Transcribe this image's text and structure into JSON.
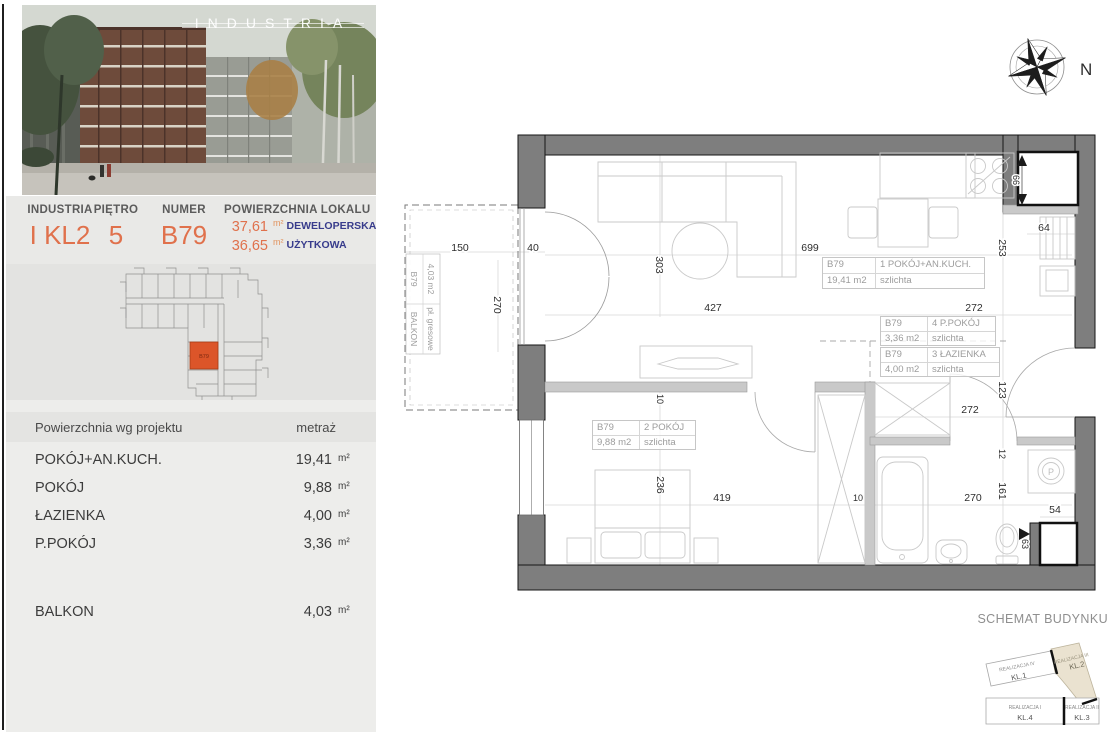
{
  "hero": {
    "overlay_title": "INDUSTRIA"
  },
  "summary": {
    "columns": [
      {
        "label": "INDUSTRIA",
        "value": "I KL2"
      },
      {
        "label": "PIĘTRO",
        "value": "5"
      },
      {
        "label": "NUMER",
        "value": "B79"
      }
    ],
    "area_label": "POWIERZCHNIA LOKALU",
    "areas": [
      {
        "value": "37,61",
        "unit": "m²",
        "kind": "DEWELOPERSKA"
      },
      {
        "value": "36,65",
        "unit": "m²",
        "kind": "UŻYTKOWA"
      }
    ]
  },
  "site_plan": {
    "highlight_unit": "B79"
  },
  "area_table": {
    "header_left": "Powierzchnia wg projektu",
    "header_right": "metraż",
    "rows": [
      {
        "name": "POKÓJ+AN.KUCH.",
        "value": "19,41",
        "unit": "m²"
      },
      {
        "name": "POKÓJ",
        "value": "9,88",
        "unit": "m²"
      },
      {
        "name": "ŁAZIENKA",
        "value": "4,00",
        "unit": "m²"
      },
      {
        "name": "P.POKÓJ",
        "value": "3,36",
        "unit": "m²"
      },
      {
        "name": "BALKON",
        "value": "4,03",
        "unit": "m²"
      }
    ]
  },
  "floor_plan": {
    "compass_label": "N",
    "washer_symbol": "P",
    "rooms": [
      {
        "unit": "B79",
        "name": "1 POKÓJ+AN.KUCH.",
        "area": "19,41 m2",
        "floor": "szlichta"
      },
      {
        "unit": "B79",
        "name": "2 POKÓJ",
        "area": "9,88 m2",
        "floor": "szlichta"
      },
      {
        "unit": "B79",
        "name": "3 ŁAZIENKA",
        "area": "4,00 m2",
        "floor": "szlichta"
      },
      {
        "unit": "B79",
        "name": "4 P.POKÓJ",
        "area": "3,36 m2",
        "floor": "szlichta"
      },
      {
        "unit": "B79",
        "name": "BALKON",
        "area": "4,03 m2",
        "floor": "pł. gresowe"
      }
    ],
    "dims": {
      "balcony_width": "150",
      "balcony_door": "40",
      "balcony_depth": "270",
      "kitchen_width": "699",
      "living_width": "427",
      "living_height": "303",
      "kitchen_depth": "253",
      "shaft_top_h": "66",
      "shaft_top_w": "64",
      "kitchen_right": "272",
      "hall_width": "272",
      "hall_depth": "123",
      "wall_a": "12",
      "bath_depth": "161",
      "bath_width": "270",
      "shaft_bottom_w": "54",
      "shaft_bottom_h": "63",
      "bed_width": "419",
      "bed_depth": "236",
      "wall_bed": "10",
      "wall_bath": "10"
    }
  },
  "building_schematic": {
    "title": "SCHEMAT BUDYNKU",
    "blocks": [
      {
        "realization": "REALIZACJA IV",
        "stair": "KL.1",
        "highlighted": false
      },
      {
        "realization": "REALIZACJA III",
        "stair": "KL.2",
        "highlighted": true
      },
      {
        "realization": "REALIZACJA I",
        "stair": "KL.4",
        "highlighted": false
      },
      {
        "realization": "REALIZACJA II",
        "stair": "KL.3",
        "highlighted": false
      }
    ]
  },
  "colors": {
    "accent_orange": "#E0714C",
    "navy_label": "#383C8C",
    "site_highlight": "#DC5529",
    "wall_gray": "#7E7E7E",
    "schematic_highlight": "#EAE2D0"
  }
}
